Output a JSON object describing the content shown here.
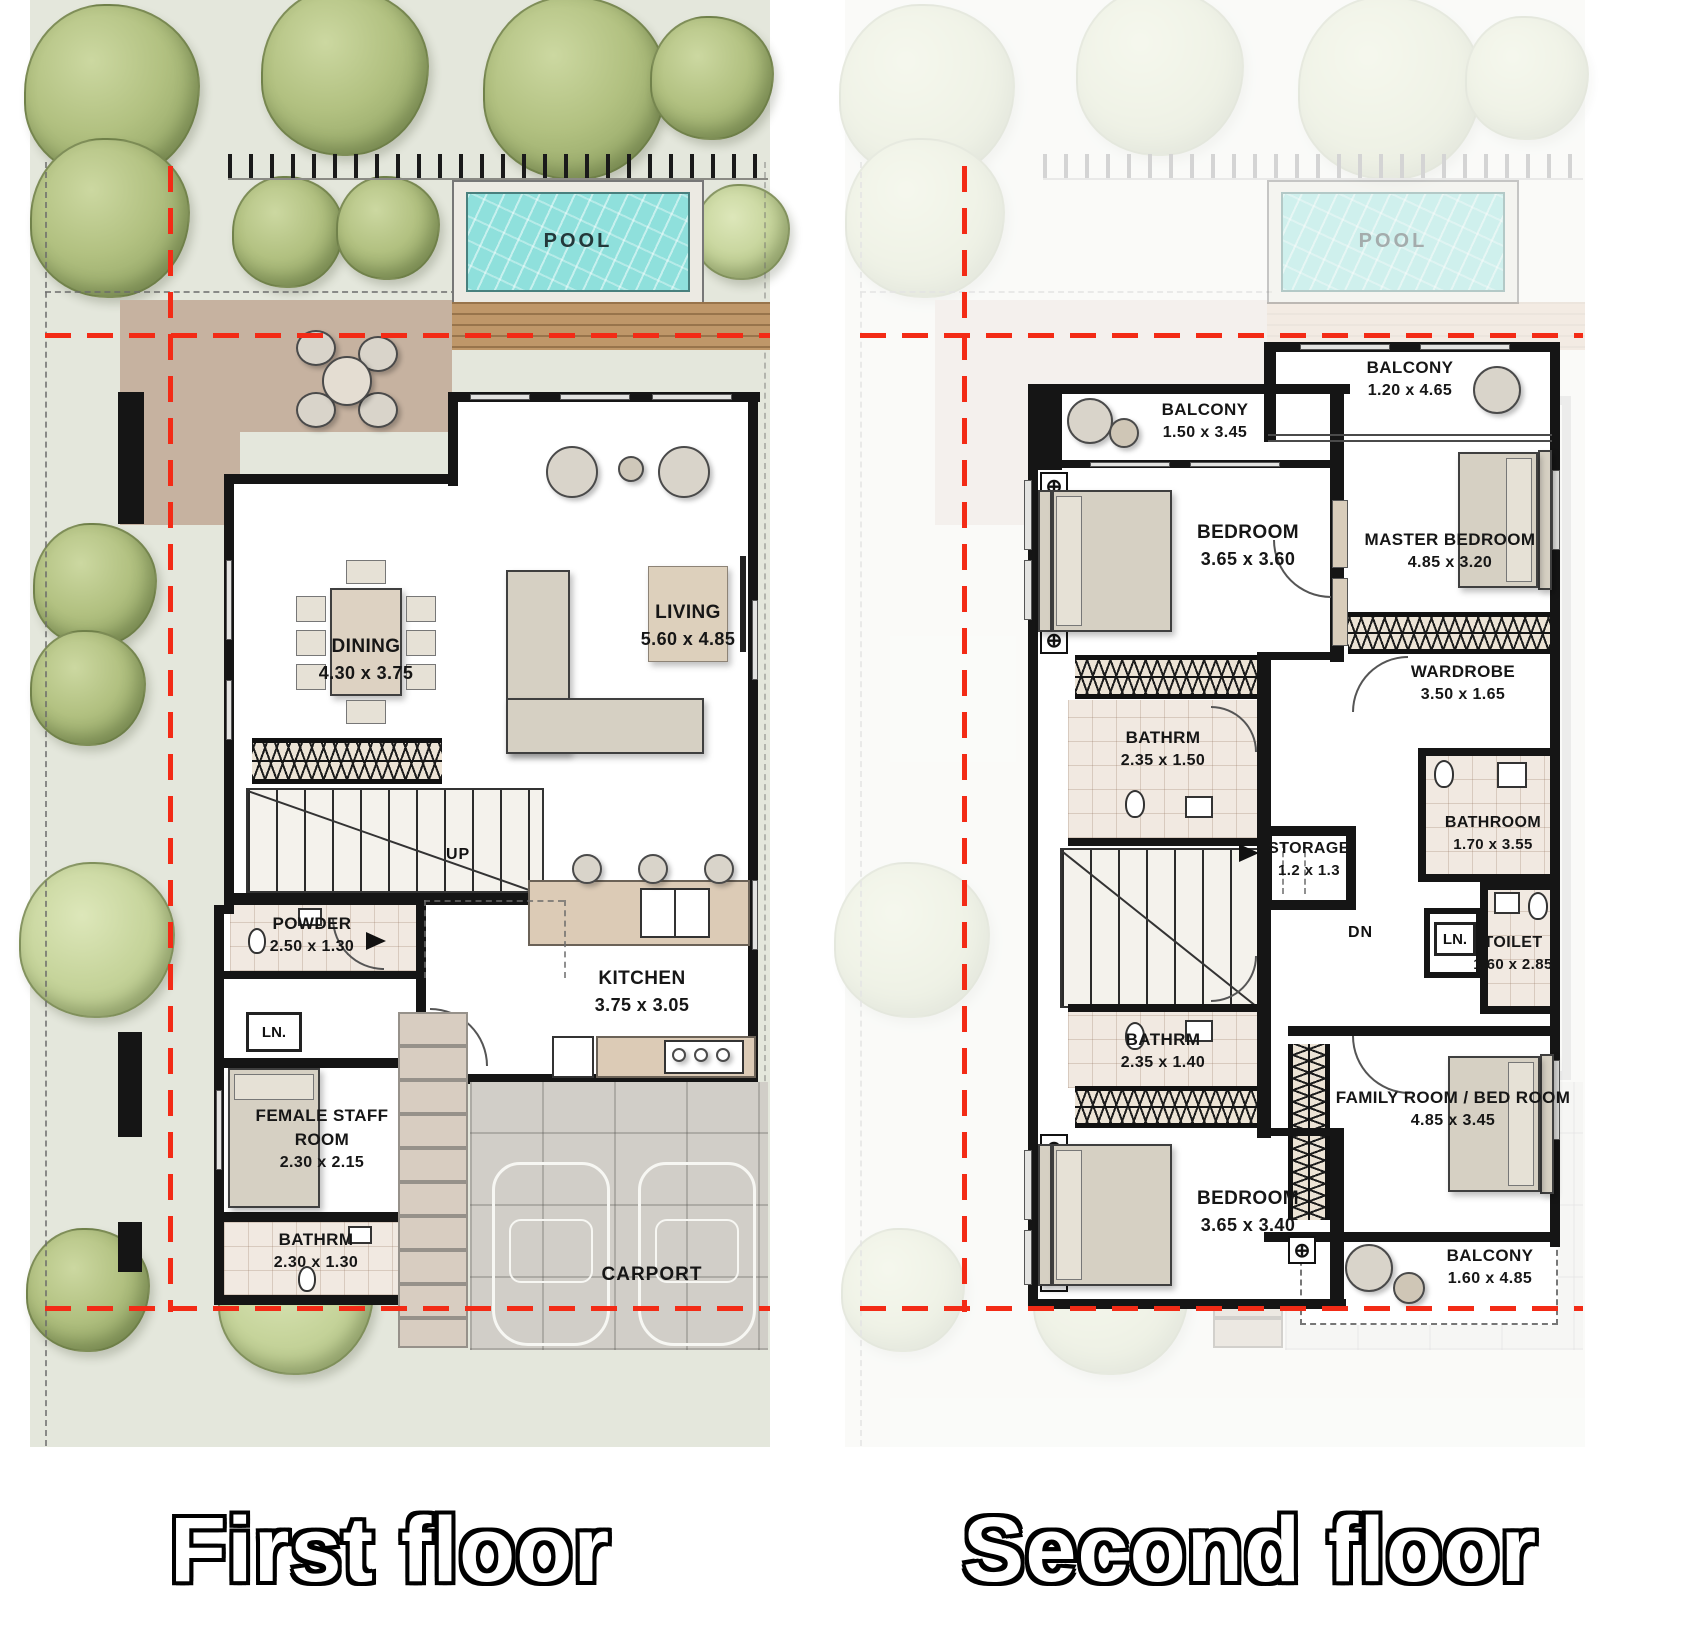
{
  "colors": {
    "garden_green": "#e4e7dc",
    "tree_green": "#aebc7e",
    "pool_water": "#8fe0dc",
    "deck_wood": "#bf9769",
    "terrace_tan": "#c6b2a0",
    "wall_black": "#151515",
    "setback_red": "#f32b16",
    "counter_beige": "#dccbb6",
    "carport_gray": "#d1cec8"
  },
  "first_floor": {
    "title": "First floor",
    "pool": {
      "name": "POOL"
    },
    "stairs": {
      "direction": "UP"
    },
    "rooms": {
      "dining": {
        "name": "DINING",
        "dims": "4.30 x 3.75"
      },
      "living": {
        "name": "LIVING",
        "dims": "5.60 x 4.85"
      },
      "powder": {
        "name": "POWDER",
        "dims": "2.50 x 1.30"
      },
      "kitchen": {
        "name": "KITCHEN",
        "dims": "3.75 x 3.05"
      },
      "linen": {
        "name": "LN."
      },
      "staff": {
        "name": "FEMALE STAFF ROOM",
        "dims": "2.30 x 2.15"
      },
      "bathroom": {
        "name": "BATHRM",
        "dims": "2.30 x 1.30"
      },
      "carport": {
        "name": "CARPORT"
      }
    }
  },
  "second_floor": {
    "title": "Second floor",
    "pool": {
      "name": "POOL"
    },
    "stairs": {
      "direction": "DN"
    },
    "rooms": {
      "balcony_left": {
        "name": "BALCONY",
        "dims": "1.50 x 3.45"
      },
      "balcony_right": {
        "name": "BALCONY",
        "dims": "1.20 x 4.65"
      },
      "bedroom_top": {
        "name": "BEDROOM",
        "dims": "3.65 x 3.60"
      },
      "master_bedroom": {
        "name": "MASTER BEDROOM",
        "dims": "4.85 x 3.20"
      },
      "wardrobe": {
        "name": "WARDROBE",
        "dims": "3.50 x 1.65"
      },
      "bathrm_top": {
        "name": "BATHRM",
        "dims": "2.35 x 1.50"
      },
      "storage": {
        "name": "STORAGE",
        "dims": "1.2 x 1.3"
      },
      "bathroom": {
        "name": "BATHROOM",
        "dims": "1.70 x 3.55"
      },
      "toilet": {
        "name": "TOILET",
        "dims": "1.60 x 2.85"
      },
      "linen": {
        "name": "LN."
      },
      "bathrm_bottom": {
        "name": "BATHRM",
        "dims": "2.35 x 1.40"
      },
      "bedroom_bottom": {
        "name": "BEDROOM",
        "dims": "3.65 x 3.40"
      },
      "family_room": {
        "name": "FAMILY ROOM / BED ROOM",
        "dims": "4.85 x 3.45"
      },
      "balcony_bottom": {
        "name": "BALCONY",
        "dims": "1.60 x 4.85"
      }
    }
  }
}
